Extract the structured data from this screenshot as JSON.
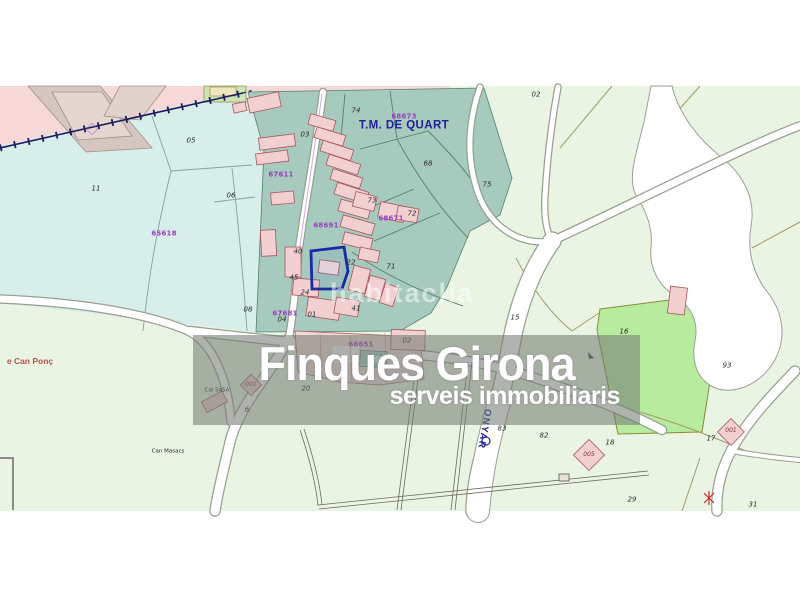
{
  "watermark": {
    "agency": "Finques Girona",
    "agency_tagline": "serveis immobiliaris",
    "portal": "habitaclia"
  },
  "map": {
    "municipality": "T.M. DE QUART",
    "river": "ONYAR",
    "colors": {
      "countryside_green": "#e9f5e2",
      "zone_cyan": "#d8eeea",
      "field_teal": "#a7cabe",
      "urban_pink": "#f6d8d8",
      "parcel16_green": "#b7eb9e",
      "highlight_parcel_blue": "#1a2aa0",
      "cadastral_ref_purple": "#9a3fc0",
      "municipality_navy": "#20209a",
      "watermark_band_gray": "rgba(116,124,116,0.58)"
    },
    "labels": [
      {
        "t": "05",
        "x": 191,
        "y": 141,
        "c": "n"
      },
      {
        "t": "11",
        "x": 96,
        "y": 189,
        "c": "n"
      },
      {
        "t": "06",
        "x": 231,
        "y": 196,
        "c": "n"
      },
      {
        "t": "08",
        "x": 248,
        "y": 310,
        "c": "n"
      },
      {
        "t": "03",
        "x": 305,
        "y": 135,
        "c": "n"
      },
      {
        "t": "74",
        "x": 356,
        "y": 111,
        "c": "n"
      },
      {
        "t": "02",
        "x": 536,
        "y": 95,
        "c": "n"
      },
      {
        "t": "68",
        "x": 428,
        "y": 164,
        "c": "n"
      },
      {
        "t": "75",
        "x": 487,
        "y": 185,
        "c": "n"
      },
      {
        "t": "73",
        "x": 372,
        "y": 201,
        "c": "n"
      },
      {
        "t": "72",
        "x": 412,
        "y": 214,
        "c": "n"
      },
      {
        "t": "71",
        "x": 391,
        "y": 267,
        "c": "n"
      },
      {
        "t": "22",
        "x": 351,
        "y": 263,
        "c": "n"
      },
      {
        "t": "40",
        "x": 298,
        "y": 252,
        "c": "n"
      },
      {
        "t": "45",
        "x": 294,
        "y": 278,
        "c": "n"
      },
      {
        "t": "24",
        "x": 305,
        "y": 293,
        "c": "n"
      },
      {
        "t": "41",
        "x": 356,
        "y": 309,
        "c": "n"
      },
      {
        "t": "01",
        "x": 312,
        "y": 315,
        "c": "n"
      },
      {
        "t": "04",
        "x": 282,
        "y": 320,
        "c": "n"
      },
      {
        "t": "02",
        "x": 407,
        "y": 341,
        "c": "n"
      },
      {
        "t": "20",
        "x": 306,
        "y": 389,
        "c": "n"
      },
      {
        "t": "6",
        "x": 247,
        "y": 410,
        "c": "n"
      },
      {
        "t": "001",
        "x": 251,
        "y": 385,
        "c": "nd"
      },
      {
        "t": "16",
        "x": 624,
        "y": 332,
        "c": "n"
      },
      {
        "t": "15",
        "x": 515,
        "y": 318,
        "c": "n"
      },
      {
        "t": "93",
        "x": 727,
        "y": 366,
        "c": "n"
      },
      {
        "t": "83",
        "x": 502,
        "y": 429,
        "c": "n"
      },
      {
        "t": "82",
        "x": 544,
        "y": 436,
        "c": "n"
      },
      {
        "t": "005",
        "x": 589,
        "y": 455,
        "c": "nd"
      },
      {
        "t": "18",
        "x": 610,
        "y": 443,
        "c": "n"
      },
      {
        "t": "17",
        "x": 711,
        "y": 439,
        "c": "n"
      },
      {
        "t": "001",
        "x": 731,
        "y": 431,
        "c": "nd"
      },
      {
        "t": "29",
        "x": 632,
        "y": 500,
        "c": "n"
      },
      {
        "t": "31",
        "x": 753,
        "y": 505,
        "c": "n"
      },
      {
        "t": "67611",
        "x": 281,
        "y": 175,
        "c": "ref"
      },
      {
        "t": "65618",
        "x": 164,
        "y": 234,
        "c": "ref"
      },
      {
        "t": "68673",
        "x": 404,
        "y": 117,
        "c": "ref"
      },
      {
        "t": "68671",
        "x": 391,
        "y": 219,
        "c": "ref"
      },
      {
        "t": "68691",
        "x": 326,
        "y": 226,
        "c": "ref"
      },
      {
        "t": "67681",
        "x": 285,
        "y": 314,
        "c": "ref"
      },
      {
        "t": "68651",
        "x": 361,
        "y": 345,
        "c": "ref"
      },
      {
        "t": "T.M. DE QUART",
        "x": 404,
        "y": 126,
        "c": "muni"
      },
      {
        "t": "ONYAR",
        "x": 484,
        "y": 429,
        "c": "river",
        "r": 100
      },
      {
        "t": "e Can Ponç",
        "x": 30,
        "y": 361,
        "c": "pr"
      },
      {
        "t": "Can Masacs",
        "x": 168,
        "y": 452,
        "c": "pd"
      },
      {
        "t": "Cal 545A",
        "x": 217,
        "y": 391,
        "c": "pd"
      }
    ]
  }
}
